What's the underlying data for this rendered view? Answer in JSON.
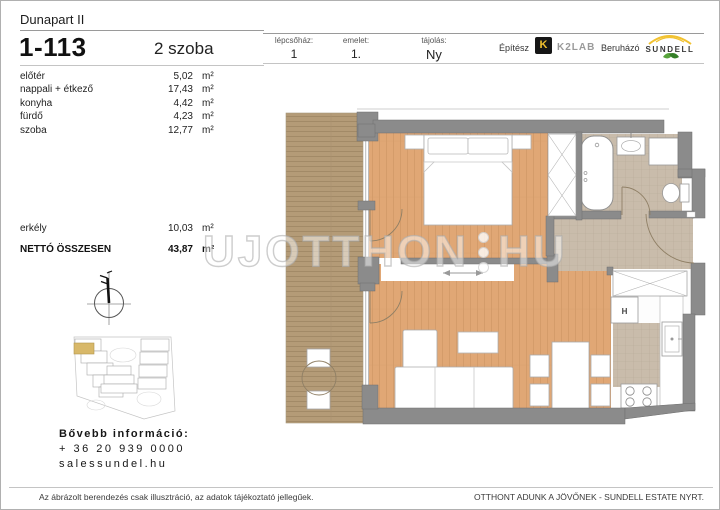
{
  "header": {
    "project": "Dunapart II",
    "unit_id": "1-113",
    "room_count": "2 szoba",
    "info": {
      "staircase_label": "lépcsőház:",
      "staircase_value": "1",
      "floor_label": "emelet:",
      "floor_value": "1.",
      "orientation_label": "tájolás:",
      "orientation_value": "Ny",
      "architect_label": "Építész",
      "architect_brand": "K2LAB",
      "architect_logo_glyph": "K",
      "developer_label": "Beruházó",
      "developer_brand": "SUNDELL"
    }
  },
  "areas": {
    "rows": [
      {
        "name": "előtér",
        "value": "5,02",
        "unit": "m²"
      },
      {
        "name": "nappali + étkező",
        "value": "17,43",
        "unit": "m²"
      },
      {
        "name": "konyha",
        "value": "4,42",
        "unit": "m²"
      },
      {
        "name": "fürdő",
        "value": "4,23",
        "unit": "m²"
      },
      {
        "name": "szoba",
        "value": "12,77",
        "unit": "m²"
      }
    ],
    "balcony": {
      "name": "erkély",
      "value": "10,03",
      "unit": "m²"
    },
    "total": {
      "name": "NETTÓ ÖSSZESEN",
      "value": "43,87",
      "unit": "m²"
    }
  },
  "floorplan": {
    "fridge_label": "H"
  },
  "watermark": {
    "left": "UJOTTHON",
    "right": "HU"
  },
  "contact": {
    "title": "Bővebb információ:",
    "phone": "+ 36 20 939 0000",
    "website": "salessundel.hu"
  },
  "footer": {
    "disclaimer": "Az ábrázolt berendezés csak illusztráció, az adatok tájékoztató jellegűek.",
    "slogan": "OTTHONT ADUNK A JÖVŐNEK - SUNDELL ESTATE NYRT."
  },
  "colors": {
    "wood_floor": "#e0a775",
    "balcony_wood": "#b49b77",
    "tile_floor": "#c9bcab",
    "wall": "#8b8b8b",
    "brand_yellow": "#f0c02e",
    "brand_green": "#4a9b35",
    "site_highlight": "#d8b869"
  }
}
